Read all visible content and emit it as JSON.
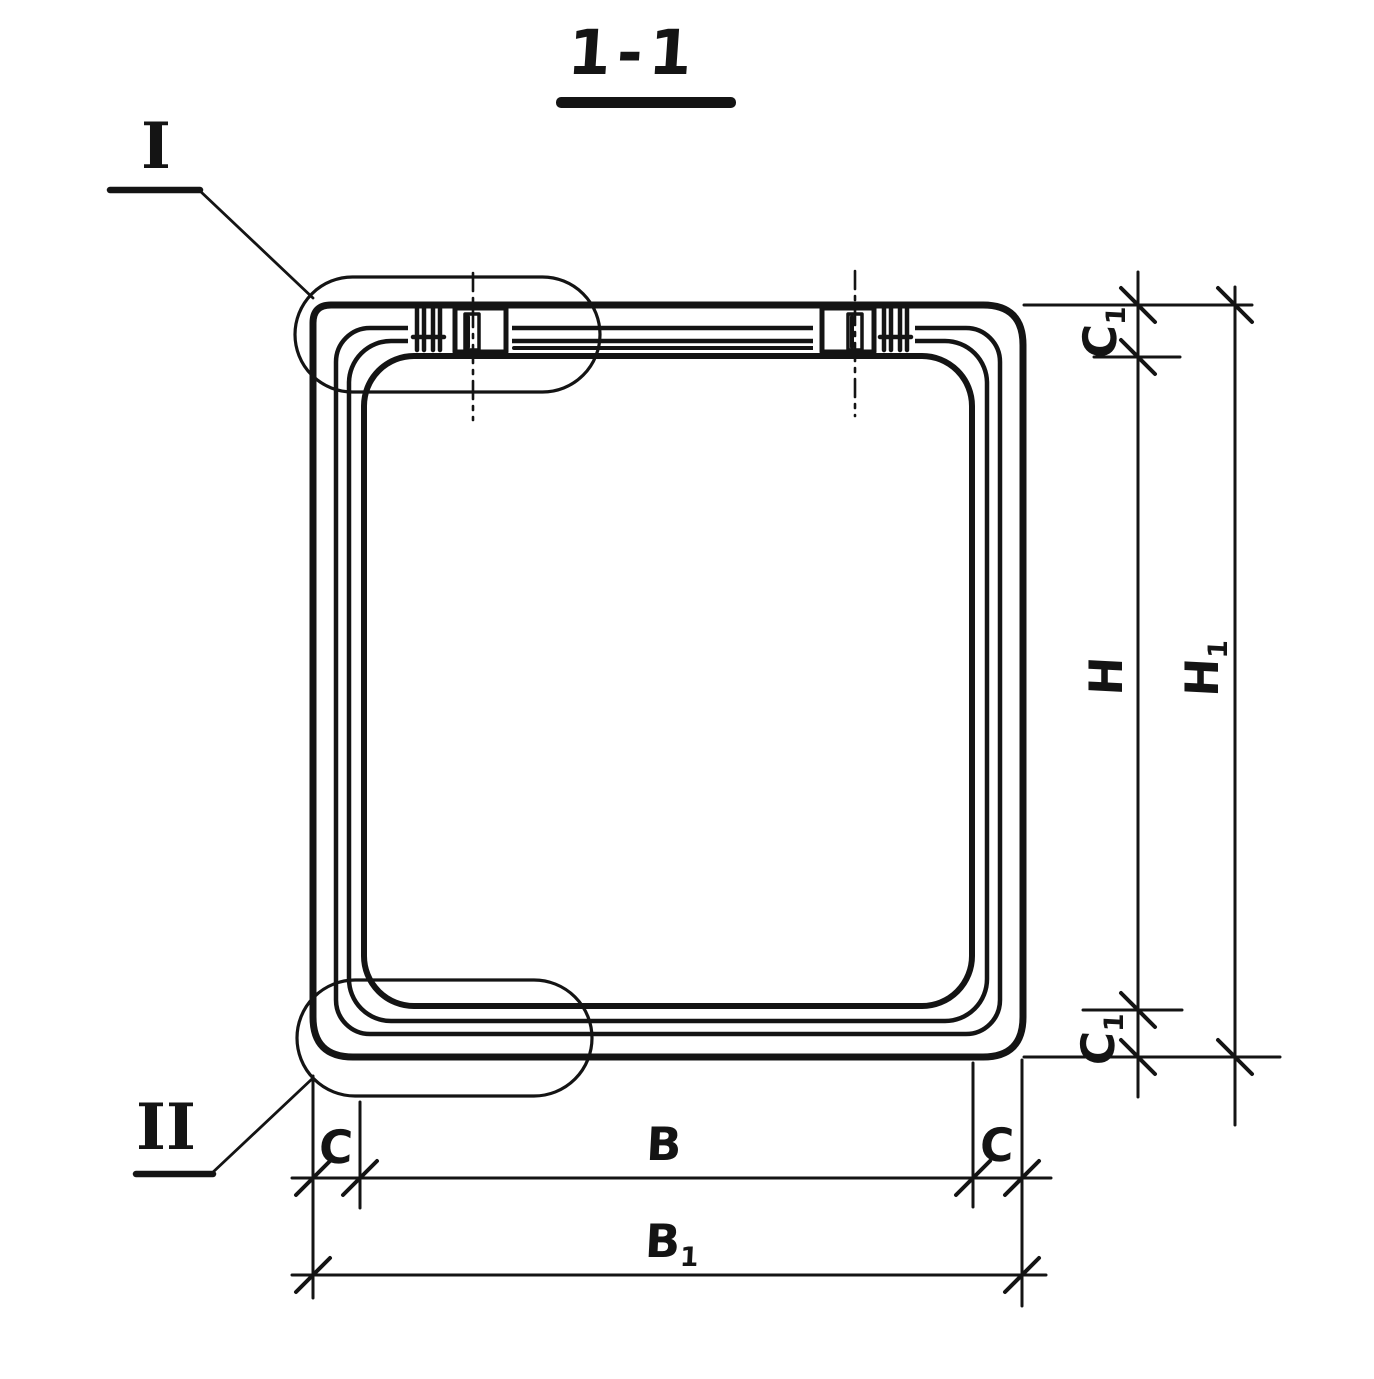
{
  "page": {
    "paper_color": "#ffffff",
    "ink_color": "#141414"
  },
  "drawing": {
    "section_title": "1-1",
    "detail_markers": [
      {
        "id": "I",
        "label": "I"
      },
      {
        "id": "II",
        "label": "II"
      }
    ],
    "dimension_labels": {
      "c1_top": {
        "base": "C",
        "sub": "1"
      },
      "h": {
        "base": "H",
        "sub": ""
      },
      "h1": {
        "base": "H",
        "sub": "1"
      },
      "c1_bottom": {
        "base": "C",
        "sub": "1"
      },
      "c_left": {
        "base": "C",
        "sub": ""
      },
      "b": {
        "base": "B",
        "sub": ""
      },
      "c_right": {
        "base": "C",
        "sub": ""
      },
      "b1": {
        "base": "B",
        "sub": "1"
      }
    }
  }
}
